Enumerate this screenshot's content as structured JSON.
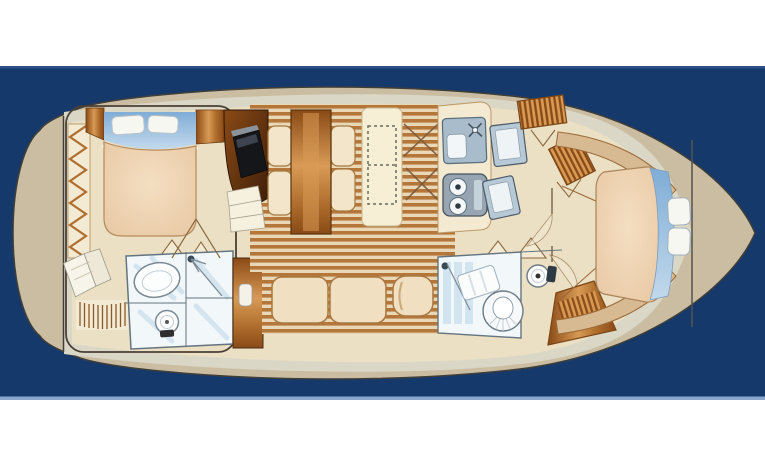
{
  "meta": {
    "description": "Top-down illustrated deck plan of a motor yacht interior on a navy blue band",
    "diagram_type": "boat-floor-plan",
    "orientation": "bow-right-stern-left"
  },
  "colors": {
    "page_bg": "#ffffff",
    "water_navy": "#16396b",
    "navy_edge_top": "#2c5186",
    "navy_edge_bottom": "#8aa6cc",
    "hull_tan": "#cbbda2",
    "hull_outline": "#3f3e38",
    "deck_band": "#dad7c7",
    "interior_cream": "#ebdfc4",
    "wall_cream": "#f3ead3",
    "wood_dark": "#8a4a16",
    "wood_mid": "#b06f2e",
    "wood_light": "#d89a55",
    "darkwood_deep": "#3c1d08",
    "plank_dark": "#b5763a",
    "plank_light": "#e9d8b8",
    "bed_peach": "#e8c7a2",
    "bed_light": "#f4dfc2",
    "blue_dark": "#7fadd6",
    "blue_light": "#c2d9ec",
    "pillow_white": "#f7f7f2",
    "tile_white": "#f2f7fa",
    "tile_blue": "#cfe2ef",
    "fixture_line": "#64757f",
    "appliance_gray": "#a8bccb",
    "appliance_dark": "#97a5b2",
    "outline_brown": "#8a6a42",
    "outline_dark": "#4a4036"
  },
  "rooms": [
    {
      "id": "aft-cabin",
      "name": "Aft master cabin",
      "furniture": [
        "double berth",
        "two pillows",
        "zigzag hanging locker",
        "wood side cabinets",
        "steps"
      ]
    },
    {
      "id": "aft-head",
      "name": "Aft bathroom",
      "furniture": [
        "oval washbasin",
        "toilet",
        "shower"
      ]
    },
    {
      "id": "salon",
      "name": "Salon dinette",
      "furniture": [
        "wood dining table",
        "four upholstered seats",
        "corner TV cabinet",
        "sideboard bench with hatch"
      ]
    },
    {
      "id": "lower-salon",
      "name": "Lower salon",
      "furniture": [
        "two-cushion settee",
        "armchair"
      ]
    },
    {
      "id": "galley",
      "name": "Galley",
      "furniture": [
        "sink with faucet",
        "two-burner stove",
        "refrigerator",
        "freezer"
      ]
    },
    {
      "id": "companionway",
      "name": "Companionway",
      "furniture": [
        "hanging lockers",
        "door swings"
      ]
    },
    {
      "id": "forward-head",
      "name": "Forward bathroom",
      "furniture": [
        "shower",
        "round shell washbasin",
        "toilet",
        "hanging locker"
      ]
    },
    {
      "id": "forward-cabin",
      "name": "Forward cabin",
      "furniture": [
        "tapered double berth",
        "blue blanket",
        "two stacked pillows",
        "curved side shelves"
      ]
    }
  ]
}
